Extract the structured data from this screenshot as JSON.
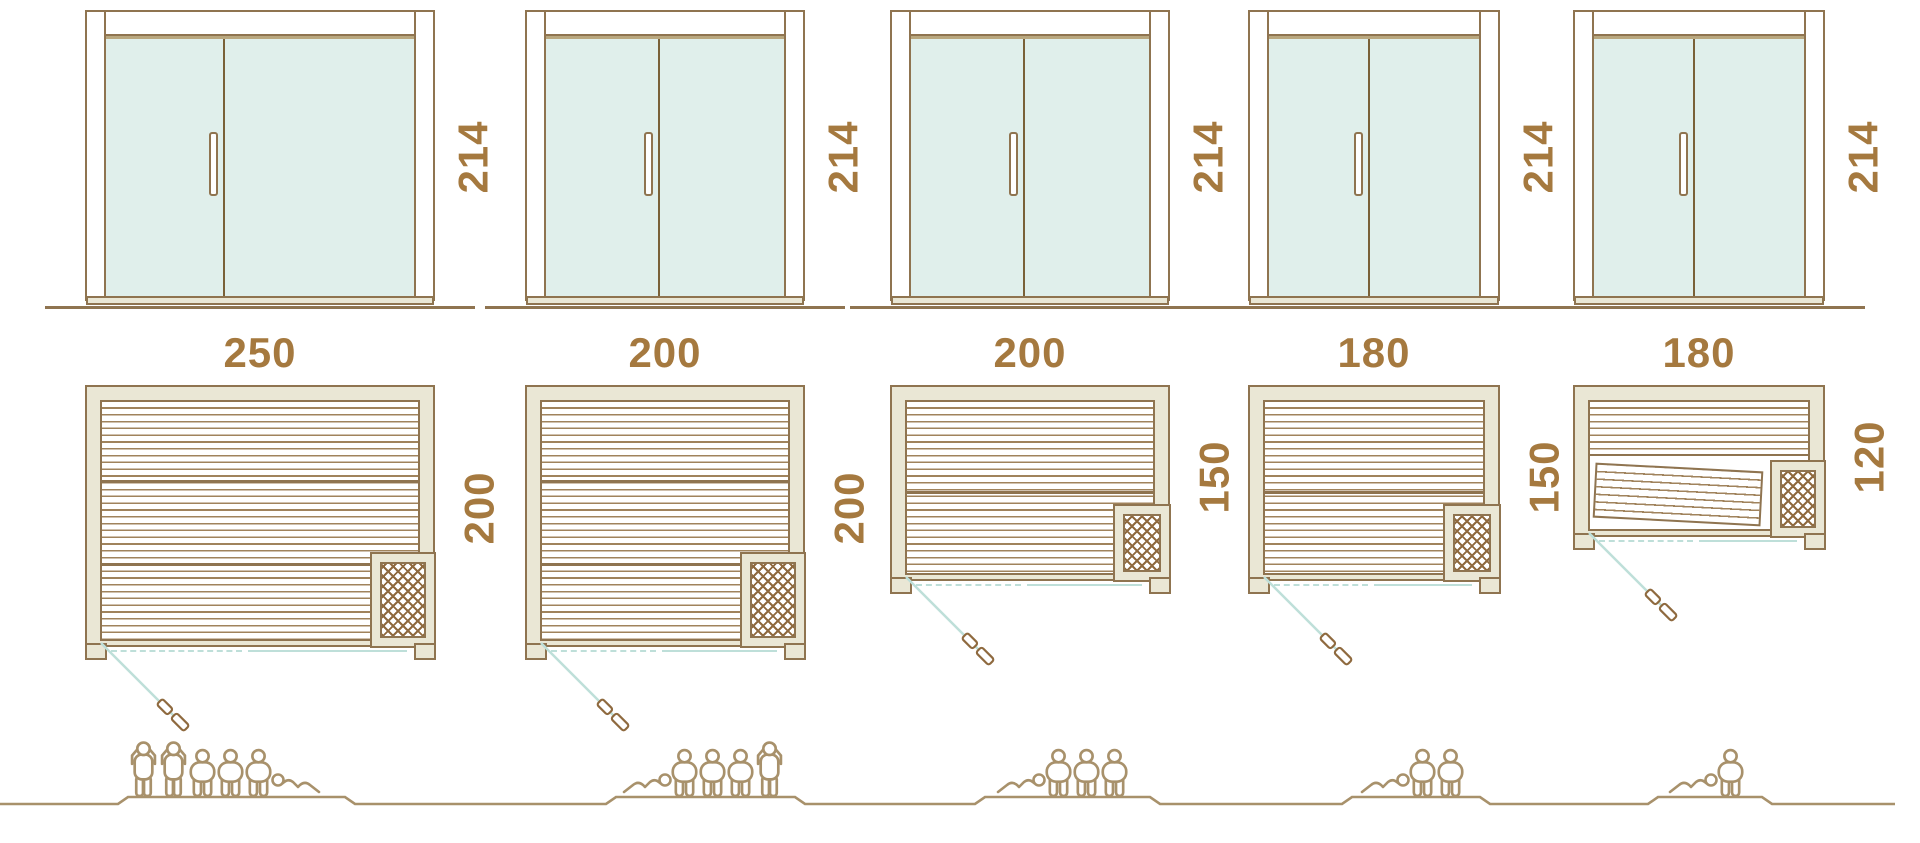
{
  "diagram": {
    "type": "sauna-size-comparison",
    "units": "cm",
    "columns": [
      {
        "id": 1,
        "door": {
          "height_label": "214"
        },
        "plan": {
          "width_label": "250",
          "depth_label": "200"
        },
        "occupants": {
          "count": 6,
          "arrangement": [
            "standing",
            "standing",
            "sitting",
            "sitting",
            "sitting",
            "lying-right"
          ]
        }
      },
      {
        "id": 2,
        "door": {
          "height_label": "214"
        },
        "plan": {
          "width_label": "200",
          "depth_label": "200"
        },
        "occupants": {
          "count": 5,
          "arrangement": [
            "lying-left",
            "sitting",
            "sitting",
            "sitting",
            "standing"
          ]
        }
      },
      {
        "id": 3,
        "door": {
          "height_label": "214"
        },
        "plan": {
          "width_label": "200",
          "depth_label": "150"
        },
        "occupants": {
          "count": 4,
          "arrangement": [
            "lying-left",
            "sitting",
            "sitting",
            "sitting"
          ]
        }
      },
      {
        "id": 4,
        "door": {
          "height_label": "214"
        },
        "plan": {
          "width_label": "180",
          "depth_label": "150"
        },
        "occupants": {
          "count": 3,
          "arrangement": [
            "lying-left",
            "sitting",
            "sitting"
          ]
        }
      },
      {
        "id": 5,
        "door": {
          "height_label": "214"
        },
        "plan": {
          "width_label": "180",
          "depth_label": "120"
        },
        "occupants": {
          "count": 2,
          "arrangement": [
            "lying-left",
            "sitting"
          ]
        }
      }
    ],
    "colors": {
      "outline": "#8f7450",
      "wall_fill": "#eae7d5",
      "glass": "#e0efeb",
      "label_text": "#a5793f",
      "figure_outline": "#a8916b",
      "door_swing": "#bedfd9",
      "background": "#ffffff"
    },
    "icons": [
      "door-handle-icon",
      "heater-icon",
      "door-swing-line",
      "door-leaf-icon",
      "person-standing-icon",
      "person-sitting-icon",
      "person-lying-icon",
      "ground-line"
    ]
  }
}
